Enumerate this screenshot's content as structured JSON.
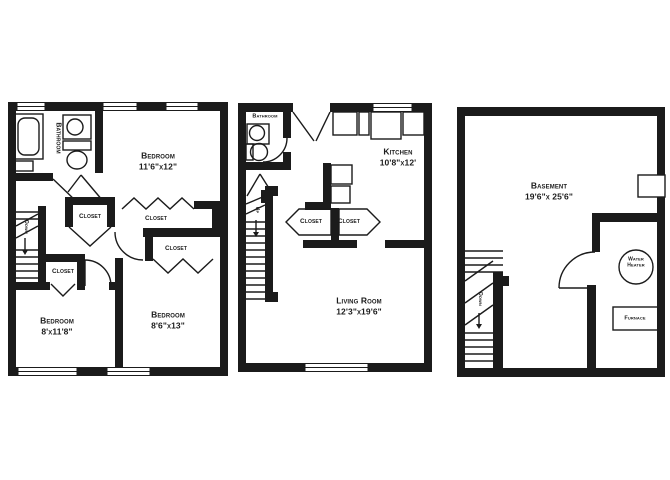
{
  "colors": {
    "wall": "#1b1b1b",
    "background": "#ffffff"
  },
  "plans": {
    "second_floor": {
      "bathroom_label": "Bathroom",
      "stairs_label": "Down",
      "bedroom_1": {
        "label": "Bedroom",
        "dims": "11'6\"x12\""
      },
      "bedroom_2": {
        "label": "Bedroom",
        "dims": "8'x11'8\""
      },
      "bedroom_3": {
        "label": "Bedroom",
        "dims": "8'6\"x13\""
      },
      "closet_1": "Closet",
      "closet_2": "Closet",
      "closet_3": "Closet",
      "closet_4": "Closet"
    },
    "first_floor": {
      "bathroom_label": "Bathroom",
      "stairs_label": "Up",
      "kitchen": {
        "label": "Kitchen",
        "dims": "10'8\"x12'"
      },
      "living_room": {
        "label": "Living Room",
        "dims": "12'3\"x19'6\""
      },
      "closet_left": "Closet",
      "closet_right": "Closet"
    },
    "basement": {
      "room": {
        "label": "Basement",
        "dims": "19'6\"x 25'6\""
      },
      "stairs_label": "Down",
      "water_heater": {
        "line1": "Water",
        "line2": "Heater"
      },
      "furnace_label": "Furnace"
    }
  }
}
